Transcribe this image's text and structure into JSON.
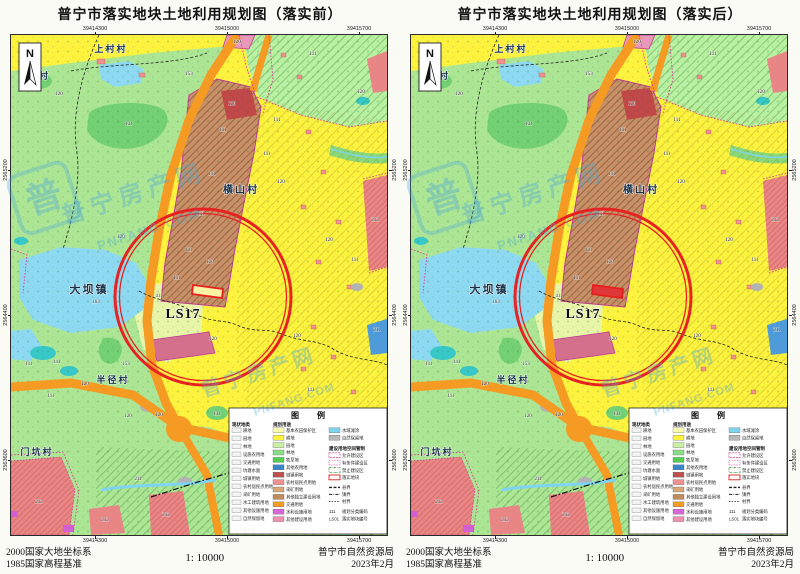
{
  "panels": [
    {
      "title": "普宁市落实地块土地利用规划图（落实前）"
    },
    {
      "title": "普宁市落实地块土地利用规划图（落实后）"
    }
  ],
  "footer": {
    "crs1": "2000国家大地坐标系",
    "crs2": "1985国家高程基准",
    "scale": "1: 10000",
    "agency": "普宁市自然资源局",
    "date": "2023年2月"
  },
  "grid": {
    "x": [
      {
        "label": "39414300",
        "x": 84
      },
      {
        "label": "39415000",
        "x": 216
      },
      {
        "label": "39415700",
        "x": 348
      }
    ],
    "y": [
      {
        "label": "2565200",
        "y": 135
      },
      {
        "label": "2564400",
        "y": 280
      },
      {
        "label": "2563600",
        "y": 425
      }
    ]
  },
  "map": {
    "north": "N",
    "ls17": "LS17",
    "places": [
      {
        "name": "上村村",
        "x": 100,
        "y": 17,
        "s": 9
      },
      {
        "name": "寨村",
        "x": 28,
        "y": 44,
        "s": 9
      },
      {
        "name": "横山村",
        "x": 230,
        "y": 158,
        "s": 10
      },
      {
        "name": "大坝镇",
        "x": 78,
        "y": 258,
        "s": 11
      },
      {
        "name": "半径村",
        "x": 102,
        "y": 348,
        "s": 9
      },
      {
        "name": "门坑村",
        "x": 26,
        "y": 420,
        "s": 9
      }
    ],
    "codes": [
      {
        "t": "111",
        "x": 97,
        "y": 14
      },
      {
        "t": "111",
        "x": 212,
        "y": 96
      },
      {
        "t": "111",
        "x": 201,
        "y": 140
      },
      {
        "t": "111",
        "x": 190,
        "y": 180
      },
      {
        "t": "111",
        "x": 178,
        "y": 216
      },
      {
        "t": "111",
        "x": 166,
        "y": 244
      },
      {
        "t": "111",
        "x": 256,
        "y": 120
      },
      {
        "t": "111",
        "x": 266,
        "y": 86
      },
      {
        "t": "111",
        "x": 302,
        "y": 20
      },
      {
        "t": "111",
        "x": 344,
        "y": 226
      },
      {
        "t": "111",
        "x": 300,
        "y": 356
      },
      {
        "t": "111",
        "x": 18,
        "y": 330
      },
      {
        "t": "111",
        "x": 46,
        "y": 328
      },
      {
        "t": "111",
        "x": 40,
        "y": 362
      },
      {
        "t": "111",
        "x": 352,
        "y": 396
      },
      {
        "t": "120",
        "x": 48,
        "y": 60
      },
      {
        "t": "120",
        "x": 226,
        "y": 8
      },
      {
        "t": "120",
        "x": 221,
        "y": 70
      },
      {
        "t": "120",
        "x": 199,
        "y": 228
      },
      {
        "t": "120",
        "x": 202,
        "y": 305
      },
      {
        "t": "120",
        "x": 270,
        "y": 148
      },
      {
        "t": "120",
        "x": 318,
        "y": 206
      },
      {
        "t": "120",
        "x": 286,
        "y": 302
      },
      {
        "t": "120",
        "x": 110,
        "y": 203
      },
      {
        "t": "120",
        "x": 74,
        "y": 350
      },
      {
        "t": "120",
        "x": 117,
        "y": 382
      },
      {
        "t": "120",
        "x": 148,
        "y": 381
      },
      {
        "t": "120",
        "x": 350,
        "y": 58
      },
      {
        "t": "131",
        "x": 118,
        "y": 90
      },
      {
        "t": "131",
        "x": 206,
        "y": 380
      },
      {
        "t": "163",
        "x": 85,
        "y": 268
      },
      {
        "t": "153",
        "x": 115,
        "y": 330
      },
      {
        "t": "153",
        "x": 178,
        "y": 40
      },
      {
        "t": "211",
        "x": 127,
        "y": 445
      },
      {
        "t": "211",
        "x": 366,
        "y": 296
      },
      {
        "t": "212",
        "x": 28,
        "y": 468
      },
      {
        "t": "212",
        "x": 94,
        "y": 486
      },
      {
        "t": "212",
        "x": 155,
        "y": 481
      },
      {
        "t": "212",
        "x": 364,
        "y": 186
      },
      {
        "t": "411",
        "x": 148,
        "y": 262
      }
    ]
  },
  "legend": {
    "title": "图 例",
    "current_header": "现状地类",
    "current": [
      "耕地",
      "园地",
      "林地",
      "设施农用地",
      "交通用地",
      "坑塘水面",
      "城镇用地",
      "农村居民点用地",
      "采矿用地",
      "水工建筑用地",
      "其他设施用地",
      "自然保留地"
    ],
    "planned_header": "规划用途",
    "planned": [
      {
        "label": "基本农田保护区",
        "color": "#ffffb0"
      },
      {
        "label": "耕地",
        "color": "#fdf23e"
      },
      {
        "label": "园地",
        "color": "#c9f2a0"
      },
      {
        "label": "林地",
        "color": "#8ade8a"
      },
      {
        "label": "牧草地",
        "color": "#52d052"
      },
      {
        "label": "其他农用地",
        "color": "#3a86c8"
      },
      {
        "label": "城镇用地",
        "color": "#c0504d"
      },
      {
        "label": "农村居民点用地",
        "color": "#ef8f8f"
      },
      {
        "label": "采矿用地",
        "color": "#d8a878"
      },
      {
        "label": "其他独立建设用地",
        "color": "#c08a5a"
      },
      {
        "label": "交通用地",
        "color": "#f59a23"
      },
      {
        "label": "水利设施用地",
        "color": "#d966d9"
      },
      {
        "label": "其他建设用地",
        "color": "#f090b0"
      }
    ],
    "water": {
      "label": "水域滩涂",
      "color": "#7fd4f0"
    },
    "nature": {
      "label": "自然保留地",
      "color": "#b8b8b8"
    },
    "control_header": "建设用地空间管制",
    "control": [
      {
        "label": "允许建设区",
        "style": "dash-magenta"
      },
      {
        "label": "有条件建设区",
        "style": "dot-magenta"
      },
      {
        "label": "禁止建设区",
        "style": "dash-green"
      },
      {
        "label": "落实地块",
        "style": "solid-red"
      }
    ],
    "boundaries": [
      {
        "label": "县界",
        "style": "county"
      },
      {
        "label": "镇界",
        "style": "town"
      },
      {
        "label": "村界",
        "style": "village"
      }
    ],
    "codes": [
      {
        "code": "111",
        "label": "规划分类编码"
      },
      {
        "code": "LS01",
        "label": "落实地块编号"
      }
    ]
  },
  "watermark": {
    "cn": "普宁房产网",
    "en": "PNFANG.COM",
    "logo_char": "普"
  }
}
